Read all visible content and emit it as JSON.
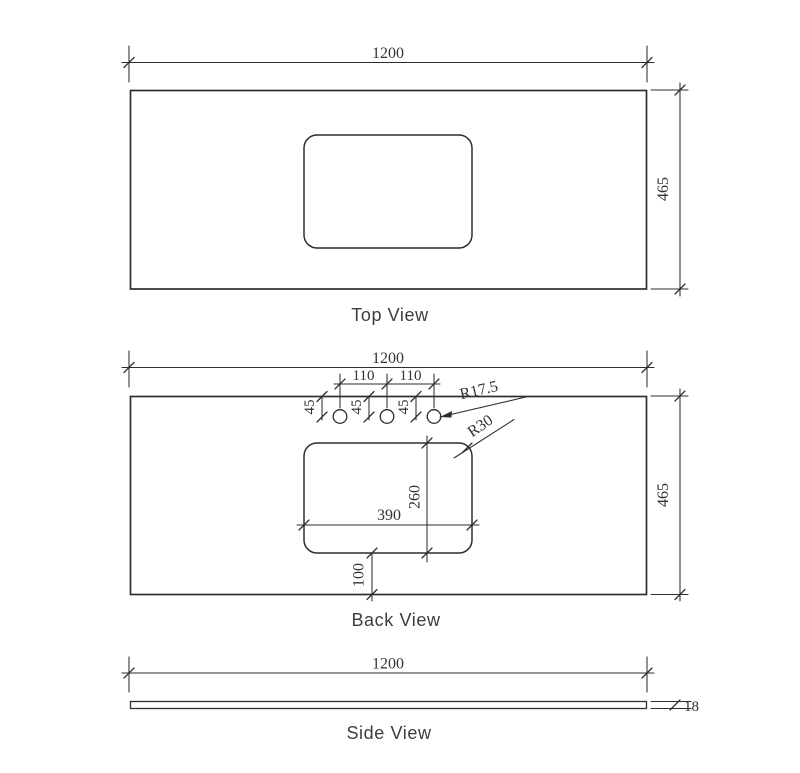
{
  "page": {
    "background": "#ffffff"
  },
  "specs": {
    "length_mm": "1200",
    "depth_mm": "465",
    "thickness_mm": "18",
    "tap_hole_spacing_mm": "110",
    "tap_hole_center_from_back_mm": "45",
    "tap_hole_radius": "R17.5",
    "cutout_corner_radius": "R30",
    "cutout_width_mm": "390",
    "cutout_depth_mm": "260",
    "cutout_from_front_mm": "100"
  },
  "drawing": {
    "width": 800,
    "height": 773,
    "stroke": "#2e2e2e",
    "text_color": "#333333",
    "views": [
      {
        "name": "top-view",
        "label": "Top View",
        "label_x": 390,
        "label_y": 321,
        "elements": [
          {
            "t": "line",
            "n": "ext-line-left",
            "x1": 129,
            "y1": 46,
            "x2": 129,
            "y2": 82
          },
          {
            "t": "line",
            "n": "ext-line-right",
            "x1": 647,
            "y1": 46,
            "x2": 647,
            "y2": 82
          },
          {
            "t": "line",
            "n": "dim-line-width",
            "x1": 122,
            "y1": 62.5,
            "x2": 654,
            "y2": 62.5
          },
          {
            "t": "tick",
            "n": "dim-tick",
            "x": 129,
            "y": 62.5
          },
          {
            "t": "tick",
            "n": "dim-tick",
            "x": 647,
            "y": 62.5
          },
          {
            "t": "text",
            "n": "dim-width-value",
            "s": "1200",
            "x": 388,
            "y": 58,
            "fs": 16
          },
          {
            "t": "rect",
            "n": "slab-outline",
            "x": 130.5,
            "y": 90.5,
            "w": 516,
            "h": 198.5,
            "sw": 1.7
          },
          {
            "t": "rect",
            "n": "basin-cutout-outline",
            "x": 304,
            "y": 135,
            "w": 168,
            "h": 113,
            "rx": 13,
            "sw": 1.5
          },
          {
            "t": "line",
            "n": "ext-line-top",
            "x1": 651,
            "y1": 90,
            "x2": 688,
            "y2": 90
          },
          {
            "t": "line",
            "n": "ext-line-bottom",
            "x1": 651,
            "y1": 289,
            "x2": 688,
            "y2": 289
          },
          {
            "t": "line",
            "n": "dim-line-depth",
            "x1": 680,
            "y1": 83,
            "x2": 680,
            "y2": 296
          },
          {
            "t": "tick",
            "n": "dim-tick",
            "x": 680,
            "y": 90
          },
          {
            "t": "tick",
            "n": "dim-tick",
            "x": 680,
            "y": 289
          },
          {
            "t": "text",
            "n": "dim-depth-value",
            "s": "465",
            "x": 668,
            "y": 189,
            "fs": 16,
            "rot": -90
          }
        ]
      },
      {
        "name": "back-view",
        "label": "Back View",
        "label_x": 396,
        "label_y": 626,
        "elements": [
          {
            "t": "line",
            "n": "ext-line-left",
            "x1": 129,
            "y1": 351,
            "x2": 129,
            "y2": 387
          },
          {
            "t": "line",
            "n": "ext-line-right",
            "x1": 647,
            "y1": 351,
            "x2": 647,
            "y2": 387
          },
          {
            "t": "line",
            "n": "dim-line-width",
            "x1": 122,
            "y1": 367.5,
            "x2": 654,
            "y2": 367.5
          },
          {
            "t": "tick",
            "n": "dim-tick",
            "x": 129,
            "y": 367.5
          },
          {
            "t": "tick",
            "n": "dim-tick",
            "x": 647,
            "y": 367.5
          },
          {
            "t": "text",
            "n": "dim-width-value",
            "s": "1200",
            "x": 388,
            "y": 363,
            "fs": 16
          },
          {
            "t": "rect",
            "n": "slab-outline",
            "x": 130.5,
            "y": 396.5,
            "w": 516,
            "h": 198,
            "sw": 1.7
          },
          {
            "t": "rect",
            "n": "basin-cutout-outline",
            "x": 304,
            "y": 443,
            "w": 168,
            "h": 110,
            "rx": 13,
            "sw": 1.5
          },
          {
            "t": "circle",
            "n": "tap-hole",
            "cx": 340,
            "cy": 416.5,
            "r": 6.8,
            "sw": 1.3
          },
          {
            "t": "circle",
            "n": "tap-hole",
            "cx": 387,
            "cy": 416.5,
            "r": 6.8,
            "sw": 1.3
          },
          {
            "t": "circle",
            "n": "tap-hole",
            "cx": 434,
            "cy": 416.5,
            "r": 6.8,
            "sw": 1.3
          },
          {
            "t": "line",
            "n": "ext-line-hole",
            "x1": 340,
            "y1": 374,
            "x2": 340,
            "y2": 408
          },
          {
            "t": "line",
            "n": "ext-line-hole",
            "x1": 387,
            "y1": 374,
            "x2": 387,
            "y2": 408
          },
          {
            "t": "line",
            "n": "ext-line-hole",
            "x1": 434,
            "y1": 374,
            "x2": 434,
            "y2": 408
          },
          {
            "t": "line",
            "n": "dim-line-hole-spacing",
            "x1": 334,
            "y1": 384,
            "x2": 440,
            "y2": 384
          },
          {
            "t": "tick",
            "n": "dim-tick",
            "x": 340,
            "y": 384
          },
          {
            "t": "tick",
            "n": "dim-tick",
            "x": 387,
            "y": 384
          },
          {
            "t": "tick",
            "n": "dim-tick",
            "x": 434,
            "y": 384
          },
          {
            "t": "text",
            "n": "dim-hole-spacing-value",
            "s": "110",
            "x": 363.5,
            "y": 380,
            "fs": 15
          },
          {
            "t": "text",
            "n": "dim-hole-spacing-value",
            "s": "110",
            "x": 410.5,
            "y": 380,
            "fs": 15
          },
          {
            "t": "line",
            "n": "dim-line-hole-offset",
            "x1": 322,
            "y1": 396.5,
            "x2": 322,
            "y2": 420
          },
          {
            "t": "tick",
            "n": "dim-tick",
            "x": 322,
            "y": 396.5
          },
          {
            "t": "tick",
            "n": "dim-tick",
            "x": 322,
            "y": 417
          },
          {
            "t": "text",
            "n": "dim-hole-offset-value",
            "s": "45",
            "x": 314,
            "y": 407,
            "fs": 15,
            "rot": -90
          },
          {
            "t": "line",
            "n": "dim-line-hole-offset",
            "x1": 369,
            "y1": 396.5,
            "x2": 369,
            "y2": 420
          },
          {
            "t": "tick",
            "n": "dim-tick",
            "x": 369,
            "y": 396.5
          },
          {
            "t": "tick",
            "n": "dim-tick",
            "x": 369,
            "y": 417
          },
          {
            "t": "text",
            "n": "dim-hole-offset-value",
            "s": "45",
            "x": 361,
            "y": 407,
            "fs": 15,
            "rot": -90
          },
          {
            "t": "line",
            "n": "dim-line-hole-offset",
            "x1": 416,
            "y1": 396.5,
            "x2": 416,
            "y2": 420
          },
          {
            "t": "tick",
            "n": "dim-tick",
            "x": 416,
            "y": 396.5
          },
          {
            "t": "tick",
            "n": "dim-tick",
            "x": 416,
            "y": 417
          },
          {
            "t": "text",
            "n": "dim-hole-offset-value",
            "s": "45",
            "x": 408,
            "y": 407,
            "fs": 15,
            "rot": -90
          },
          {
            "t": "line",
            "n": "leader-hole-radius",
            "x1": 440,
            "y1": 417,
            "x2": 528,
            "y2": 396.5
          },
          {
            "t": "arrow",
            "n": "leader-arrowhead",
            "x": 440,
            "y": 417,
            "a": -13
          },
          {
            "t": "text",
            "n": "dim-hole-radius-value",
            "s": "R17.5",
            "x": 480,
            "y": 395,
            "fs": 16,
            "rot": -13
          },
          {
            "t": "line",
            "n": "leader-corner-radius",
            "x1": 454,
            "y1": 458,
            "x2": 514,
            "y2": 419.5
          },
          {
            "t": "tick",
            "n": "dim-tick",
            "x": 467,
            "y": 448
          },
          {
            "t": "text",
            "n": "dim-corner-radius-value",
            "s": "R30",
            "x": 483,
            "y": 430,
            "fs": 16,
            "rot": -34
          },
          {
            "t": "line",
            "n": "dim-line-cutout-depth",
            "x1": 427,
            "y1": 436,
            "x2": 427,
            "y2": 562
          },
          {
            "t": "tick",
            "n": "dim-tick",
            "x": 427,
            "y": 443
          },
          {
            "t": "tick",
            "n": "dim-tick",
            "x": 427,
            "y": 553
          },
          {
            "t": "text",
            "n": "dim-cutout-depth-value",
            "s": "260",
            "x": 419.5,
            "y": 497,
            "fs": 16,
            "rot": -90
          },
          {
            "t": "line",
            "n": "dim-line-cutout-width",
            "x1": 297,
            "y1": 525,
            "x2": 479,
            "y2": 525
          },
          {
            "t": "tick",
            "n": "dim-tick",
            "x": 304,
            "y": 525
          },
          {
            "t": "tick",
            "n": "dim-tick",
            "x": 472,
            "y": 525
          },
          {
            "t": "text",
            "n": "dim-cutout-width-value",
            "s": "390",
            "x": 389,
            "y": 520,
            "fs": 16
          },
          {
            "t": "line",
            "n": "dim-line-front-offset",
            "x1": 372,
            "y1": 553,
            "x2": 372,
            "y2": 601
          },
          {
            "t": "tick",
            "n": "dim-tick",
            "x": 372,
            "y": 553
          },
          {
            "t": "tick",
            "n": "dim-tick",
            "x": 372,
            "y": 594.5
          },
          {
            "t": "text",
            "n": "dim-front-offset-value",
            "s": "100",
            "x": 363.5,
            "y": 575,
            "fs": 16,
            "rot": -90
          },
          {
            "t": "line",
            "n": "ext-line-top",
            "x1": 651,
            "y1": 396,
            "x2": 688,
            "y2": 396
          },
          {
            "t": "line",
            "n": "ext-line-bottom",
            "x1": 651,
            "y1": 594.5,
            "x2": 688,
            "y2": 594.5
          },
          {
            "t": "line",
            "n": "dim-line-depth",
            "x1": 680,
            "y1": 389,
            "x2": 680,
            "y2": 601
          },
          {
            "t": "tick",
            "n": "dim-tick",
            "x": 680,
            "y": 396
          },
          {
            "t": "tick",
            "n": "dim-tick",
            "x": 680,
            "y": 594.5
          },
          {
            "t": "text",
            "n": "dim-depth-value",
            "s": "465",
            "x": 668,
            "y": 495,
            "fs": 16,
            "rot": -90
          }
        ]
      },
      {
        "name": "side-view",
        "label": "Side View",
        "label_x": 389,
        "label_y": 739,
        "elements": [
          {
            "t": "line",
            "n": "ext-line-left",
            "x1": 129,
            "y1": 657,
            "x2": 129,
            "y2": 692
          },
          {
            "t": "line",
            "n": "ext-line-right",
            "x1": 647,
            "y1": 657,
            "x2": 647,
            "y2": 692
          },
          {
            "t": "line",
            "n": "dim-line-width",
            "x1": 122,
            "y1": 673,
            "x2": 654,
            "y2": 673
          },
          {
            "t": "tick",
            "n": "dim-tick",
            "x": 129,
            "y": 673
          },
          {
            "t": "tick",
            "n": "dim-tick",
            "x": 647,
            "y": 673
          },
          {
            "t": "text",
            "n": "dim-width-value",
            "s": "1200",
            "x": 388,
            "y": 668.5,
            "fs": 16
          },
          {
            "t": "rect",
            "n": "slab-profile-outline",
            "x": 130.5,
            "y": 701.5,
            "w": 516,
            "h": 7,
            "sw": 1.3
          },
          {
            "t": "line",
            "n": "ext-line-thickness-top",
            "x1": 651,
            "y1": 701.5,
            "x2": 691,
            "y2": 701.5
          },
          {
            "t": "line",
            "n": "ext-line-thickness-bottom",
            "x1": 651,
            "y1": 708.5,
            "x2": 691,
            "y2": 708.5
          },
          {
            "t": "tick",
            "n": "dim-tick",
            "x": 675,
            "y": 705
          },
          {
            "t": "text",
            "n": "dim-thickness-value",
            "s": "18",
            "x": 684,
            "y": 711,
            "fs": 15,
            "anchor": "start"
          }
        ]
      }
    ]
  }
}
